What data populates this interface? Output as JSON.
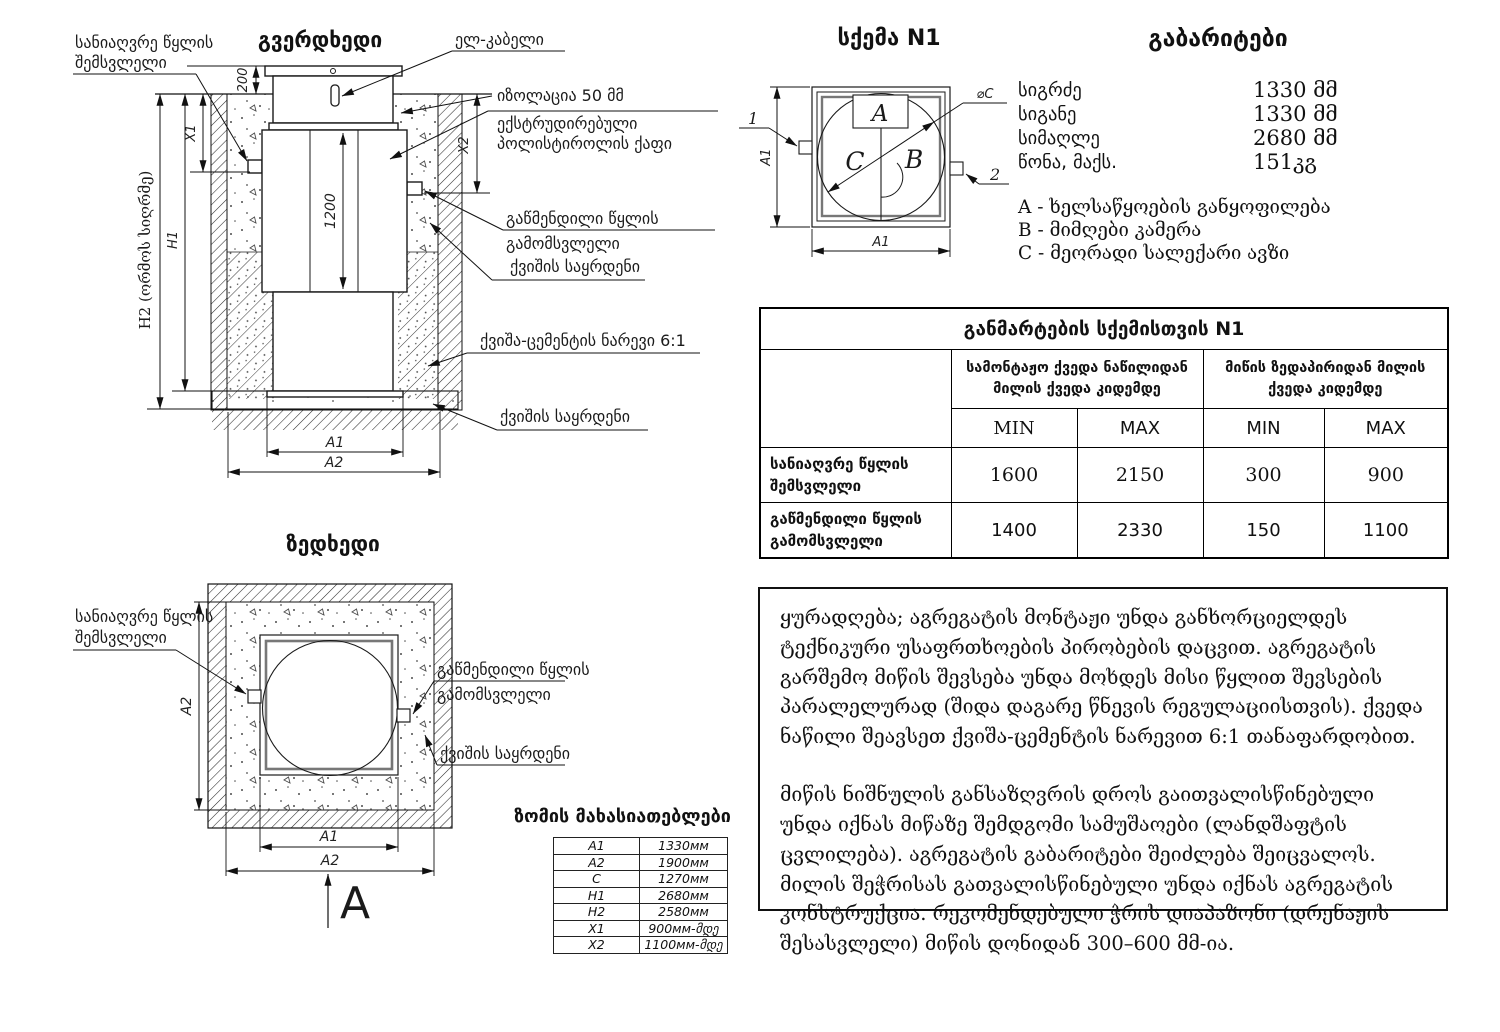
{
  "side_view": {
    "title": "გვერდხედი",
    "inlet_label_l1": "სანიაღვრე წყლის",
    "inlet_label_l2": "შემსვლელი",
    "cable_label": "ელ-კაბელი",
    "insulation_label": "იზოლაცია 50 მმ",
    "foam_label_l1": "ექსტრუდირებული",
    "foam_label_l2": "პოლისტიროლის ქაფი",
    "outlet_label_l1": "გაწმენდილი წყლის",
    "outlet_label_l2": "გამომსვლელი",
    "sand_label": "ქვიშის საყრდენი",
    "mix_label": "ქვიშა-ცემენტის ნარევი 6:1",
    "sand_label2": "ქვიშის საყრდენი",
    "dim_200": "200",
    "dim_x1": "X1",
    "dim_x2": "X2",
    "dim_h1": "H1",
    "dim_h2": "H2 (ორმოს სიღრმე)",
    "dim_1200": "1200",
    "dim_a1": "A1",
    "dim_a2": "A2"
  },
  "top_view": {
    "title": "ზედხედი",
    "inlet_label_l1": "სანიაღვრე წყლის",
    "inlet_label_l2": "შემსვლელი",
    "outlet_label_l1": "გაწმენდილი წყლის",
    "outlet_label_l2": "გამომსვლელი",
    "sand_label": "ქვიშის საყრდენი",
    "dim_a1": "A1",
    "dim_a2_left": "A2",
    "dim_a2_bottom": "A2",
    "view_marker": "A"
  },
  "scheme": {
    "title": "სქემა N1",
    "label_a": "A",
    "label_b": "B",
    "label_c": "C",
    "diameter_label": "⌀C",
    "callout_1": "1",
    "callout_2": "2",
    "dim_a1_left": "A1",
    "dim_a1_bottom": "A1"
  },
  "dimensions_panel": {
    "title": "გაბარიტები",
    "rows": [
      {
        "label": "სიგრძე",
        "value": "1330 მმ"
      },
      {
        "label": "სიგანე",
        "value": "1330 მმ"
      },
      {
        "label": "სიმაღლე",
        "value": "2680 მმ"
      },
      {
        "label": "წონა, მაქს.",
        "value": "151კგ"
      }
    ],
    "legend": [
      "A - ხელსაწყოების განყოფილება",
      "B - მიმღები კამერა",
      "C - მეორადი სალექარი ავზი"
    ]
  },
  "explanation_table": {
    "title": "განმარტების სქემისთვის N1",
    "col_group_1": "სამონტაჟო ქვედა ნაწილიდან მილის ქვედა კიდემდე",
    "col_group_2": "მიწის ზედაპირიდან მილის ქვედა კიდემდე",
    "min_label_1": "MIN",
    "max_label_1": "MAX",
    "min_label_2": "MIN",
    "max_label_2": "MAX",
    "rows": [
      {
        "label": "სანიაღვრე წყლის შემსვლელი",
        "values": [
          "1600",
          "2150",
          "300",
          "900"
        ]
      },
      {
        "label": "გაწმენდილი წყლის გამომსვლელი",
        "values": [
          "1400",
          "2330",
          "150",
          "1100"
        ]
      }
    ]
  },
  "size_table": {
    "title": "ზომის მახასიათებლები",
    "rows": [
      {
        "param": "A1",
        "value": "1330мм"
      },
      {
        "param": "A2",
        "value": "1900мм"
      },
      {
        "param": "C",
        "value": "1270мм"
      },
      {
        "param": "H1",
        "value": "2680мм"
      },
      {
        "param": "H2",
        "value": "2580мм"
      },
      {
        "param": "X1",
        "value": "900мм-მდე"
      },
      {
        "param": "X2",
        "value": "1100мм-მდე"
      }
    ]
  },
  "notes": {
    "p1": "ყურადღება; აგრეგატის მონტაჟი უნდა განხორციელდეს ტექნიკური უსაფრთხოების პირობების დაცვით. აგრეგატის გარშემო მიწის შევსება უნდა მოხდეს მისი წყლით შევსების პარალელურად (შიდა დაგარე წნევის რეგულაციისთვის). ქვედა ნაწილი შეავსეთ ქვიშა-ცემენტის ნარევით 6:1 თანაფარდობით.",
    "p2": "მიწის ნიშნულის განსაზღვრის დროს გაითვალისწინებული უნდა იქნას მიწაზე შემდგომი სამუშაოები (ლანდშაფტის ცვლილება). აგრეგატის გაბარიტები შეიძლება შეიცვალოს. მილის შეჭრისას გათვალისწინებული უნდა იქნას აგრეგატის კონსტრუქცია. რეკომენდებული ჭრის დიაპაზონი (დრენაჟის შესასვლელი) მიწის დონიდან 300–600 მმ-ია."
  }
}
